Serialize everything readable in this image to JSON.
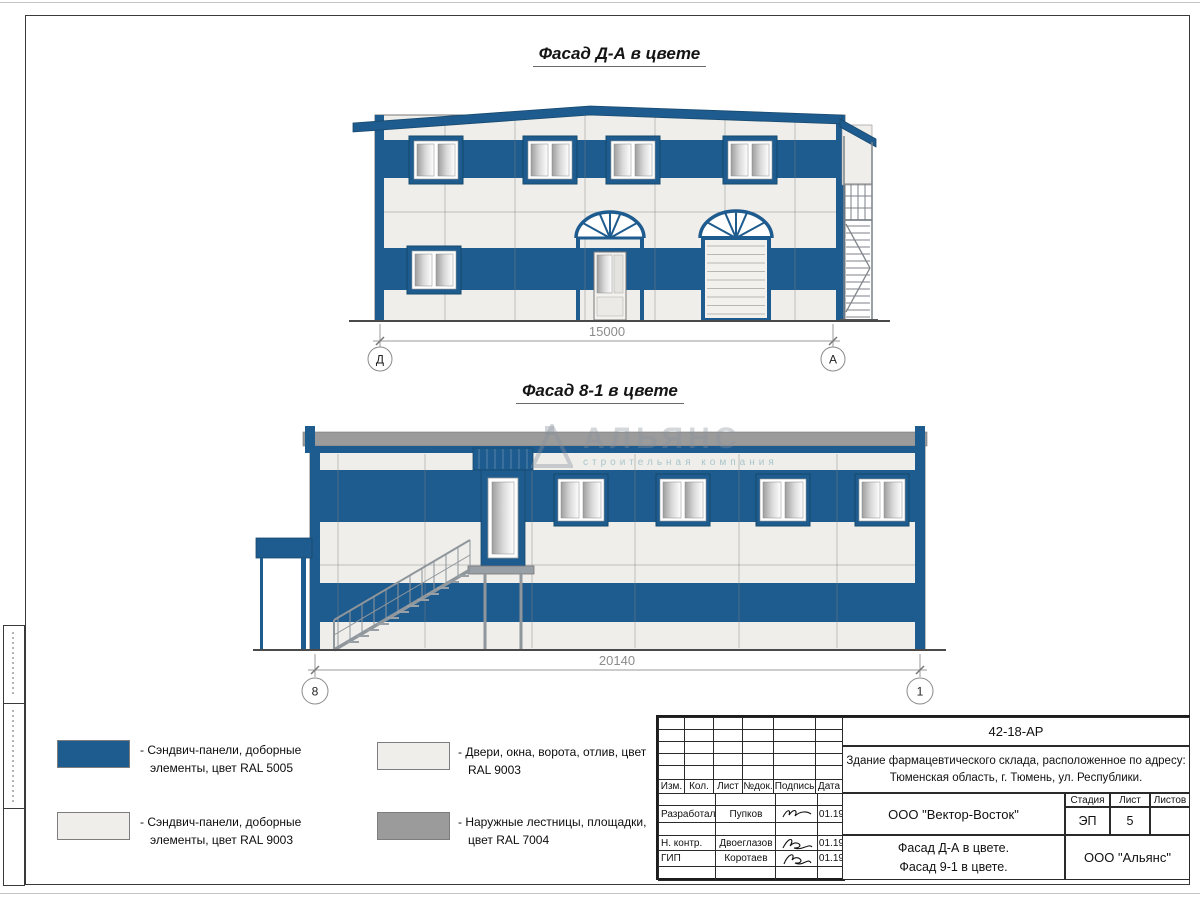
{
  "drawings": {
    "facade_da": {
      "title": "Фасад Д-А в цвете",
      "dimension_mm": "15000",
      "axis_left": "Д",
      "axis_right": "А"
    },
    "facade_81": {
      "title": "Фасад 8-1 в цвете",
      "dimension_mm": "20140",
      "axis_left": "8",
      "axis_right": "1"
    }
  },
  "watermark": {
    "name": "АЛЬЯНС",
    "tagline": "строительная компания"
  },
  "legend": {
    "items": [
      {
        "color": "#1e5b8e",
        "label": "- Сэндвич-панели, доборные элементы, цвет RAL 5005"
      },
      {
        "color": "#efeeea",
        "label": "- Сэндвич-панели, доборные элементы, цвет RAL 9003"
      },
      {
        "color": "#efeeea",
        "label": "- Двери, окна, ворота, отлив, цвет RAL 9003"
      },
      {
        "color": "#9b9b9b",
        "label": "- Наружные лестницы, площадки, цвет RAL 7004"
      }
    ]
  },
  "title_block": {
    "doc_number": "42-18-АР",
    "address_line1": "Здание фармацевтического склада, расположенное по адресу:",
    "address_line2": "Тюменская область, г. Тюмень, ул. Республики.",
    "columns": [
      "Изм.",
      "Кол.",
      "Лист",
      "№док.",
      "Подпись",
      "Дата"
    ],
    "signature_rows": [
      {
        "role": "Разработал",
        "name": "Пупков",
        "date": "01.19"
      },
      {
        "role": "Н. контр.",
        "name": "Двоеглазов",
        "date": "01.19"
      },
      {
        "role": "ГИП",
        "name": "Коротаев",
        "date": "01.19"
      }
    ],
    "company": "ООО \"Вектор-Восток\"",
    "stage_label": "Стадия",
    "sheet_label": "Лист",
    "sheets_label": "Листов",
    "stage_value": "ЭП",
    "sheet_value": "5",
    "sheets_value": "",
    "subject_line1": "Фасад Д-А в цвете.",
    "subject_line2": "Фасад 9-1 в цвете.",
    "contractor": "ООО \"Альянс\""
  },
  "palette": {
    "panel_blue_ral5005": "#1e5b8e",
    "panel_white_ral9003": "#efeeea",
    "stairs_gray_ral7004": "#9b9b9b"
  }
}
